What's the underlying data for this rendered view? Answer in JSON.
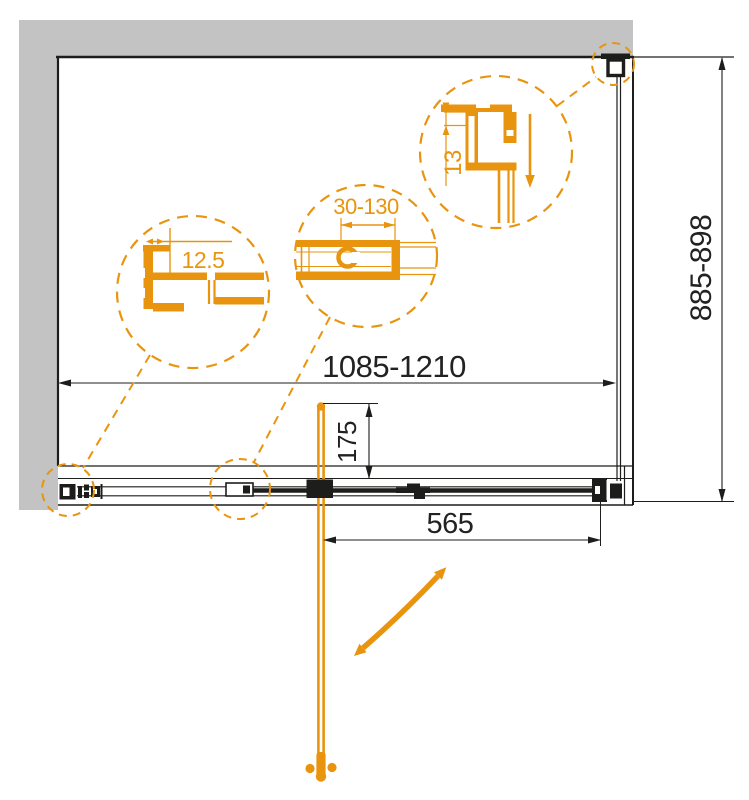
{
  "drawing": {
    "kind": "shower-enclosure-plan-technical-drawing"
  },
  "labels": {
    "overall_width": "1085-1210",
    "overall_height": "885-898",
    "door_width": "565",
    "handle_offset": "175",
    "detail_wall_profile": "12.5",
    "detail_adjustment_range": "30-130",
    "detail_top_profile": "13"
  },
  "colors": {
    "accent_orange": "#E8940F",
    "wall_gray": "#C3C3C3",
    "line_black": "#1D1D1B"
  }
}
